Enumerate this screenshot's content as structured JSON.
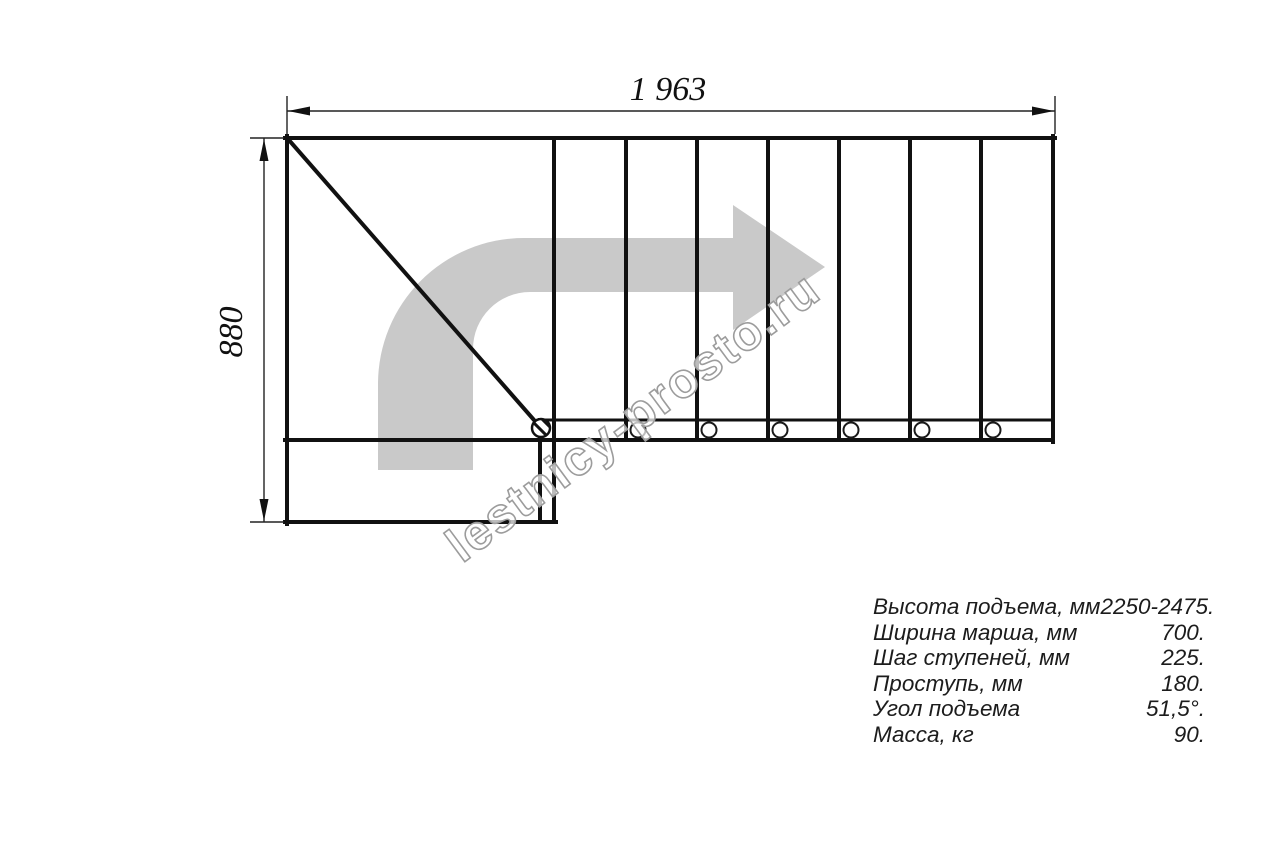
{
  "drawing": {
    "type": "staircase-plan-top-view",
    "dimensions": {
      "width_label": "1 963",
      "height_label": "880"
    },
    "plan": {
      "straight_steps_count": 7,
      "baluster_count": 6,
      "has_winder_diagonal": true
    },
    "colors": {
      "line": "#111111",
      "direction_arrow": "#c9c9c9",
      "watermark_outline": "#9c9c9c"
    }
  },
  "watermark": {
    "text": "lestnicy-prosto.ru"
  },
  "specs": {
    "rows": [
      {
        "label": "Высота подъема, мм",
        "value": "2250-2475."
      },
      {
        "label": "Ширина марша, мм",
        "value": "700."
      },
      {
        "label": "Шаг ступеней, мм",
        "value": "225."
      },
      {
        "label": "Проступь, мм",
        "value": "180."
      },
      {
        "label": "Угол подъема",
        "value": "51,5°."
      },
      {
        "label": "Масса, кг",
        "value": "90."
      }
    ]
  }
}
